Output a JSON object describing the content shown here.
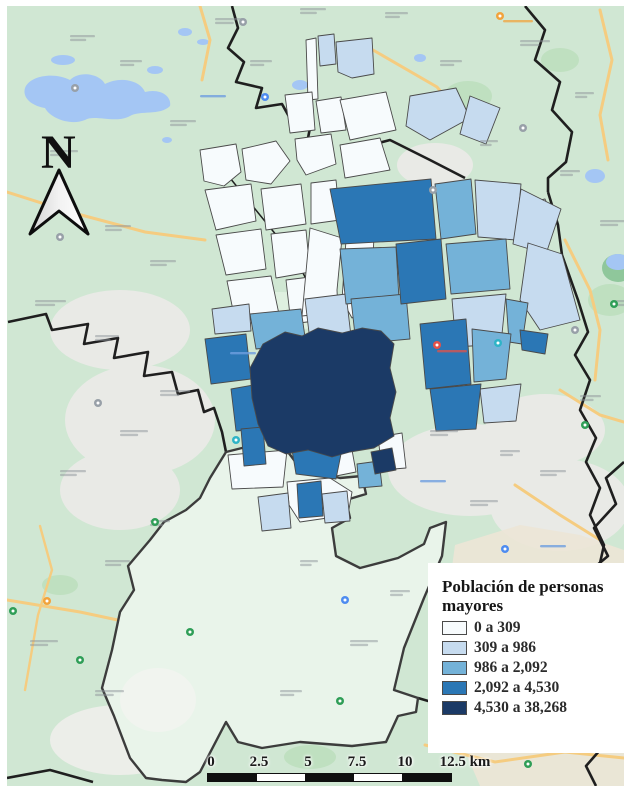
{
  "map": {
    "north_label": "N",
    "legend": {
      "title": "Población de personas mayores",
      "classes": [
        {
          "label": "0 a 309",
          "color": "#f7fbfd"
        },
        {
          "label": "309 a 986",
          "color": "#c6dbef"
        },
        {
          "label": "986 a 2,092",
          "color": "#74b2d8"
        },
        {
          "label": "2,092 a 4,530",
          "color": "#2b77b5"
        },
        {
          "label": "4,530 a 38,268",
          "color": "#1b3a66"
        }
      ]
    },
    "scale_bar": {
      "labels": [
        "0",
        "2.5",
        "5",
        "7.5",
        "10",
        "12.5 km"
      ]
    },
    "basemap_colors": {
      "land": "#d0e7d3",
      "land_pale": "#e9f4ea",
      "park": "#bfe0c0",
      "park_dark": "#8fc79b",
      "urban": "#e9eae6",
      "beige": "#ece6d6",
      "water": "#a4c6f4",
      "road": "#f5cc80",
      "boundary": "#1f1f1f"
    },
    "pin_colors": {
      "gray": "#98a0a8",
      "blue": "#4e8cf0",
      "teal": "#2fb4c7",
      "green": "#2f9e57",
      "orange": "#f2a33c",
      "red": "#e45148"
    }
  }
}
